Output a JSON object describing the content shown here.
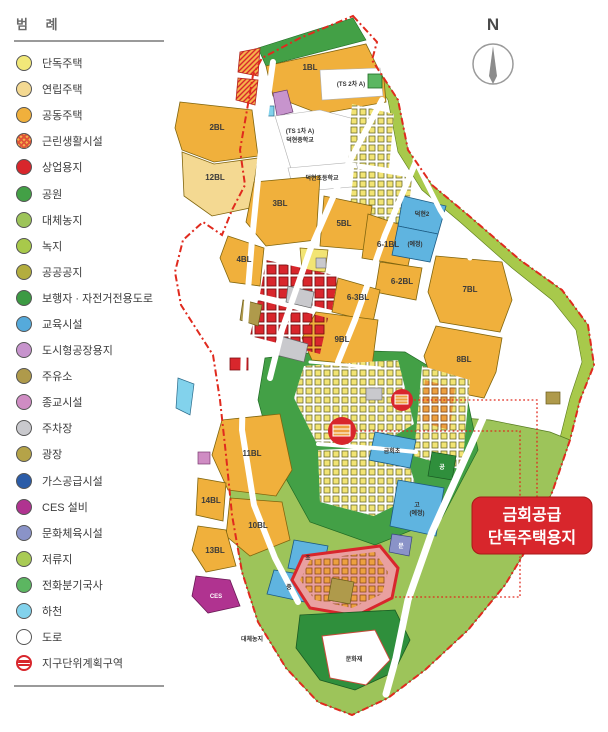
{
  "legend": {
    "title": "범 례",
    "items": [
      {
        "label": "단독주택",
        "color": "#f1e879",
        "variant": "solid"
      },
      {
        "label": "연립주택",
        "color": "#f4d992",
        "variant": "solid"
      },
      {
        "label": "공동주택",
        "color": "#f0b03c",
        "variant": "solid"
      },
      {
        "label": "근린생활시설",
        "color": "#f5b14a",
        "variant": "hatch"
      },
      {
        "label": "상업용지",
        "color": "#d8262c",
        "variant": "solid"
      },
      {
        "label": "공원",
        "color": "#43a046",
        "variant": "solid"
      },
      {
        "label": "대체농지",
        "color": "#9dc45a",
        "variant": "solid"
      },
      {
        "label": "녹지",
        "color": "#a8c94b",
        "variant": "solid"
      },
      {
        "label": "공공공지",
        "color": "#b3ad3e",
        "variant": "solid"
      },
      {
        "label": "보행자 · 자전거전용도로",
        "color": "#3c9a43",
        "variant": "solid"
      },
      {
        "label": "교육시설",
        "color": "#55aadb",
        "variant": "solid"
      },
      {
        "label": "도시형공장용지",
        "color": "#c794cd",
        "variant": "solid"
      },
      {
        "label": "주유소",
        "color": "#af9a4b",
        "variant": "solid"
      },
      {
        "label": "종교시설",
        "color": "#cf8cc3",
        "variant": "solid"
      },
      {
        "label": "주차장",
        "color": "#c9c9cd",
        "variant": "solid"
      },
      {
        "label": "광장",
        "color": "#b5a348",
        "variant": "solid"
      },
      {
        "label": "가스공급시설",
        "color": "#2b5ca8",
        "variant": "solid"
      },
      {
        "label": "CES 설비",
        "color": "#b03390",
        "variant": "solid"
      },
      {
        "label": "문화체육시설",
        "color": "#8a93c8",
        "variant": "solid"
      },
      {
        "label": "저류지",
        "color": "#a9cb55",
        "variant": "solid"
      },
      {
        "label": "전화분기국사",
        "color": "#5cb661",
        "variant": "solid"
      },
      {
        "label": "하천",
        "color": "#82d2ec",
        "variant": "solid"
      },
      {
        "label": "도로",
        "color": "#ffffff",
        "variant": "road"
      },
      {
        "label": "지구단위계획구역",
        "color": "#d8262c",
        "variant": "boundary"
      }
    ]
  },
  "compass": {
    "label": "N"
  },
  "map": {
    "blocks": {
      "b1": "1BL",
      "b2": "2BL",
      "b3": "3BL",
      "b4": "4BL",
      "b5": "5BL",
      "b6_1": "6-1BL",
      "b6_2": "6-2BL",
      "b6_3": "6-3BL",
      "b7": "7BL",
      "b8": "8BL",
      "b9": "9BL",
      "b10": "10BL",
      "b11": "11BL",
      "b12": "12BL",
      "b13": "13BL",
      "b14": "14BL"
    },
    "labels": {
      "ts2": "(TS 2차 A)",
      "ts1": "(TS 1차 A)",
      "mid_school": "덕현중학교",
      "elem_school": "덕현초등학교",
      "school_a": "덕현2",
      "school_b": "(예정)",
      "geumhoe_elem": "금회초",
      "park_small": "공",
      "high_school": "고",
      "high_school_note": "(예정)",
      "elem_small": "초",
      "mid_small": "중",
      "ces": "CES",
      "culture_small": "문",
      "farmland": "대체농지",
      "heritage": "문화재"
    },
    "callout": {
      "line1": "금회공급",
      "line2": "단독주택용지"
    },
    "colors": {
      "boundary": "#e02a1e",
      "callout_bg": "#d8262c"
    }
  }
}
